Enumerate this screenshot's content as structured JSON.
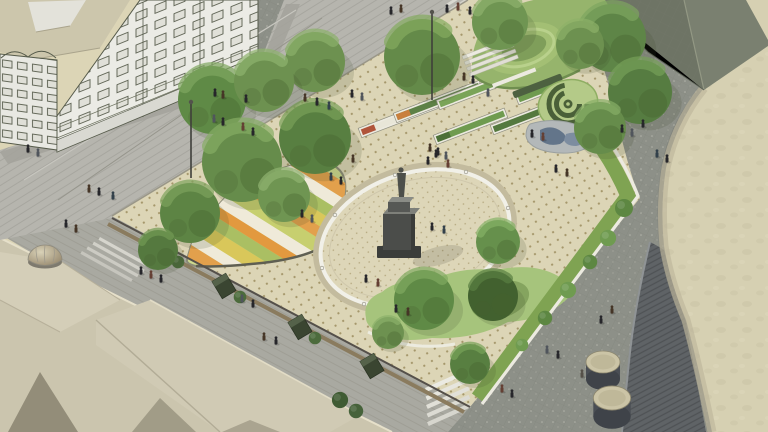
{
  "meta": {
    "description": "Aerial architectural rendering of a public square: oval plaza with monument, striped garden mound, planter benches, grass amphitheatre mound, spiral hedge garden, playground, lawns, surrounding streets, sketched facades and a curved stone building"
  },
  "palette": {
    "plaza_paving": "#dcd5b6",
    "paving_dot": "#a5976b",
    "street_light": "#b6b5ae",
    "street_dark": "#8d9088",
    "cream_building": "#d6d0b2",
    "ribbed_wall": "#5f6366",
    "faceted_roof": "#6e7465",
    "sketch_facade": "#ebebe5",
    "sketch_line": "#565b4b",
    "rooftop_beige": "#cbc5ae",
    "lawn_green": "#a6c47c",
    "mound_green": "#96b46c",
    "grass_strip": "#7fa352",
    "tree_green": "#6d9150",
    "kiosk_green": "#3a4531",
    "monument_gray": "#4b4d4a",
    "oval_ring_white": "#f1f0e8",
    "stripe_orange": "#e2a04c",
    "stripe_yellow": "#d9c75a",
    "stripe_red": "#b0543a"
  },
  "scene": {
    "trees": [
      {
        "x": 315,
        "y": 62,
        "s": 3.0,
        "c1": "#6d9150",
        "c2": "#8cb06a"
      },
      {
        "x": 422,
        "y": 57,
        "s": 3.8,
        "c1": "#648a49",
        "c2": "#85ab60"
      },
      {
        "x": 500,
        "y": 22,
        "s": 2.8,
        "c1": "#6f9552",
        "c2": "#8fb26e"
      },
      {
        "x": 212,
        "y": 100,
        "s": 3.4,
        "c1": "#5f8a46",
        "c2": "#7fa75f"
      },
      {
        "x": 264,
        "y": 82,
        "s": 3.0,
        "c1": "#6d9150",
        "c2": "#8fb36d"
      },
      {
        "x": 315,
        "y": 138,
        "s": 3.6,
        "c1": "#587f41",
        "c2": "#79a058"
      },
      {
        "x": 242,
        "y": 162,
        "s": 4.0,
        "c1": "#668c4b",
        "c2": "#86ac64"
      },
      {
        "x": 190,
        "y": 213,
        "s": 3.0,
        "c1": "#5d8444",
        "c2": "#7da35c"
      },
      {
        "x": 158,
        "y": 250,
        "s": 2.0,
        "c1": "#55793f",
        "c2": "#729a54"
      },
      {
        "x": 284,
        "y": 196,
        "s": 2.6,
        "c1": "#6f9552",
        "c2": "#90b470"
      },
      {
        "x": 612,
        "y": 38,
        "s": 3.4,
        "c1": "#5e8547",
        "c2": "#7ea55f"
      },
      {
        "x": 640,
        "y": 92,
        "s": 3.2,
        "c1": "#567c41",
        "c2": "#76a058"
      },
      {
        "x": 600,
        "y": 128,
        "s": 2.6,
        "c1": "#668c4b",
        "c2": "#88ae66"
      },
      {
        "x": 580,
        "y": 45,
        "s": 2.4,
        "c1": "#6d9150",
        "c2": "#8db168"
      },
      {
        "x": 498,
        "y": 242,
        "s": 2.2,
        "c1": "#66904c",
        "c2": "#86b266"
      },
      {
        "x": 424,
        "y": 300,
        "s": 3.0,
        "c1": "#5f8a46",
        "c2": "#80aa60"
      },
      {
        "x": 493,
        "y": 296,
        "s": 2.5,
        "c1": "#42612f",
        "c2": "#5a7f42"
      },
      {
        "x": 388,
        "y": 333,
        "s": 1.6,
        "c1": "#6d9150",
        "c2": "#8cb06a"
      },
      {
        "x": 470,
        "y": 364,
        "s": 2.0,
        "c1": "#587f41",
        "c2": "#78a259"
      }
    ],
    "bushes": [
      {
        "x": 624,
        "y": 208,
        "s": 1.0,
        "c": "#5d8742"
      },
      {
        "x": 608,
        "y": 238,
        "s": 0.9,
        "c": "#6f9b50"
      },
      {
        "x": 590,
        "y": 262,
        "s": 0.8,
        "c": "#5d8742"
      },
      {
        "x": 568,
        "y": 290,
        "s": 0.9,
        "c": "#6f9b50"
      },
      {
        "x": 545,
        "y": 318,
        "s": 0.8,
        "c": "#5d8742"
      },
      {
        "x": 522,
        "y": 345,
        "s": 0.7,
        "c": "#6f9b50"
      },
      {
        "x": 178,
        "y": 262,
        "s": 0.7,
        "c": "#4c6b3c"
      },
      {
        "x": 240,
        "y": 297,
        "s": 0.7,
        "c": "#4c6b3c"
      },
      {
        "x": 315,
        "y": 338,
        "s": 0.7,
        "c": "#4c6b3c"
      },
      {
        "x": 340,
        "y": 400,
        "s": 0.9,
        "c": "#3f5b33"
      },
      {
        "x": 356,
        "y": 411,
        "s": 0.8,
        "c": "#46623a"
      }
    ],
    "people": [
      {
        "x": 215,
        "y": 95,
        "c": "#26262a"
      },
      {
        "x": 223,
        "y": 97,
        "c": "#453526"
      },
      {
        "x": 246,
        "y": 101,
        "c": "#26262a"
      },
      {
        "x": 214,
        "y": 121,
        "c": "#50555c"
      },
      {
        "x": 223,
        "y": 124,
        "c": "#26262a"
      },
      {
        "x": 243,
        "y": 129,
        "c": "#643f33"
      },
      {
        "x": 253,
        "y": 134,
        "c": "#26262a"
      },
      {
        "x": 305,
        "y": 100,
        "c": "#453526"
      },
      {
        "x": 317,
        "y": 104,
        "c": "#26262a"
      },
      {
        "x": 329,
        "y": 108,
        "c": "#32404a"
      },
      {
        "x": 352,
        "y": 96,
        "c": "#26262a"
      },
      {
        "x": 362,
        "y": 99,
        "c": "#50555c"
      },
      {
        "x": 391,
        "y": 13,
        "c": "#26262a"
      },
      {
        "x": 401,
        "y": 11,
        "c": "#453526"
      },
      {
        "x": 447,
        "y": 11,
        "c": "#26262a"
      },
      {
        "x": 458,
        "y": 9,
        "c": "#643f33"
      },
      {
        "x": 470,
        "y": 13,
        "c": "#26262a"
      },
      {
        "x": 28,
        "y": 151,
        "c": "#26262a"
      },
      {
        "x": 38,
        "y": 155,
        "c": "#50555c"
      },
      {
        "x": 89,
        "y": 191,
        "c": "#453526"
      },
      {
        "x": 99,
        "y": 194,
        "c": "#26262a"
      },
      {
        "x": 113,
        "y": 198,
        "c": "#32404a"
      },
      {
        "x": 66,
        "y": 226,
        "c": "#26262a"
      },
      {
        "x": 76,
        "y": 231,
        "c": "#453526"
      },
      {
        "x": 141,
        "y": 273,
        "c": "#26262a"
      },
      {
        "x": 151,
        "y": 277,
        "c": "#643f33"
      },
      {
        "x": 161,
        "y": 281,
        "c": "#26262a"
      },
      {
        "x": 242,
        "y": 301,
        "c": "#50555c"
      },
      {
        "x": 253,
        "y": 306,
        "c": "#26262a"
      },
      {
        "x": 264,
        "y": 339,
        "c": "#453526"
      },
      {
        "x": 276,
        "y": 343,
        "c": "#26262a"
      },
      {
        "x": 331,
        "y": 179,
        "c": "#32404a"
      },
      {
        "x": 341,
        "y": 183,
        "c": "#26262a"
      },
      {
        "x": 353,
        "y": 161,
        "c": "#453526"
      },
      {
        "x": 302,
        "y": 216,
        "c": "#26262a"
      },
      {
        "x": 312,
        "y": 221,
        "c": "#50555c"
      },
      {
        "x": 366,
        "y": 281,
        "c": "#26262a"
      },
      {
        "x": 378,
        "y": 285,
        "c": "#643f33"
      },
      {
        "x": 396,
        "y": 311,
        "c": "#26262a"
      },
      {
        "x": 408,
        "y": 314,
        "c": "#453526"
      },
      {
        "x": 432,
        "y": 229,
        "c": "#26262a"
      },
      {
        "x": 444,
        "y": 232,
        "c": "#32404a"
      },
      {
        "x": 436,
        "y": 156,
        "c": "#26262a"
      },
      {
        "x": 430,
        "y": 150,
        "c": "#453526"
      },
      {
        "x": 438,
        "y": 154,
        "c": "#26262a"
      },
      {
        "x": 446,
        "y": 158,
        "c": "#50555c"
      },
      {
        "x": 428,
        "y": 163,
        "c": "#26262a"
      },
      {
        "x": 448,
        "y": 166,
        "c": "#643f33"
      },
      {
        "x": 464,
        "y": 79,
        "c": "#453526"
      },
      {
        "x": 473,
        "y": 82,
        "c": "#26262a"
      },
      {
        "x": 488,
        "y": 95,
        "c": "#50555c"
      },
      {
        "x": 532,
        "y": 136,
        "c": "#26262a"
      },
      {
        "x": 543,
        "y": 139,
        "c": "#643f33"
      },
      {
        "x": 556,
        "y": 171,
        "c": "#26262a"
      },
      {
        "x": 567,
        "y": 175,
        "c": "#453526"
      },
      {
        "x": 622,
        "y": 131,
        "c": "#26262a"
      },
      {
        "x": 632,
        "y": 135,
        "c": "#50555c"
      },
      {
        "x": 643,
        "y": 126,
        "c": "#26262a"
      },
      {
        "x": 657,
        "y": 156,
        "c": "#32404a"
      },
      {
        "x": 667,
        "y": 161,
        "c": "#26262a"
      },
      {
        "x": 612,
        "y": 312,
        "c": "#453526"
      },
      {
        "x": 601,
        "y": 322,
        "c": "#26262a"
      },
      {
        "x": 547,
        "y": 352,
        "c": "#50555c"
      },
      {
        "x": 558,
        "y": 357,
        "c": "#26262a"
      },
      {
        "x": 502,
        "y": 391,
        "c": "#643f33"
      },
      {
        "x": 512,
        "y": 396,
        "c": "#26262a"
      },
      {
        "x": 582,
        "y": 376,
        "c": "#555048"
      }
    ],
    "kiosks": [
      {
        "x": 163,
        "y": 250
      },
      {
        "x": 224,
        "y": 286
      },
      {
        "x": 300,
        "y": 327
      },
      {
        "x": 372,
        "y": 366
      }
    ],
    "planters": [
      {
        "x": 360,
        "y": 133,
        "l": 82,
        "li": 78,
        "c": "#e8e6d8",
        "c2": "#b0543a"
      },
      {
        "x": 395,
        "y": 118,
        "l": 92,
        "li": 88,
        "c": "#5d8146",
        "c2": "#c97f3e"
      },
      {
        "x": 435,
        "y": 140,
        "l": 76,
        "li": 72,
        "c": "#6f9b4f",
        "c2": "#4d7038"
      },
      {
        "x": 438,
        "y": 105,
        "l": 70,
        "li": 66,
        "c": "#7aa458",
        "c2": "#7aa458"
      },
      {
        "x": 492,
        "y": 130,
        "l": 56,
        "li": 52,
        "c": "#55793f",
        "c2": "#55793f"
      },
      {
        "x": 517,
        "y": 100,
        "l": 42,
        "li": 38,
        "c": "#6f9b4f",
        "c2": "#6f9b4f"
      }
    ],
    "oval_posts": [
      {
        "x": 508,
        "y": 208
      },
      {
        "x": 495,
        "y": 261
      },
      {
        "x": 435,
        "y": 301
      },
      {
        "x": 364,
        "y": 304
      },
      {
        "x": 322,
        "y": 268
      },
      {
        "x": 335,
        "y": 215
      },
      {
        "x": 395,
        "y": 175
      },
      {
        "x": 466,
        "y": 172
      }
    ],
    "lamps": [
      {
        "x": 191,
        "y": 102,
        "h": 76
      },
      {
        "x": 432,
        "y": 12,
        "h": 88
      }
    ],
    "cylinders": [
      {
        "x": 603,
        "y": 362,
        "s": 1.0
      },
      {
        "x": 612,
        "y": 398,
        "s": 1.1
      }
    ]
  }
}
